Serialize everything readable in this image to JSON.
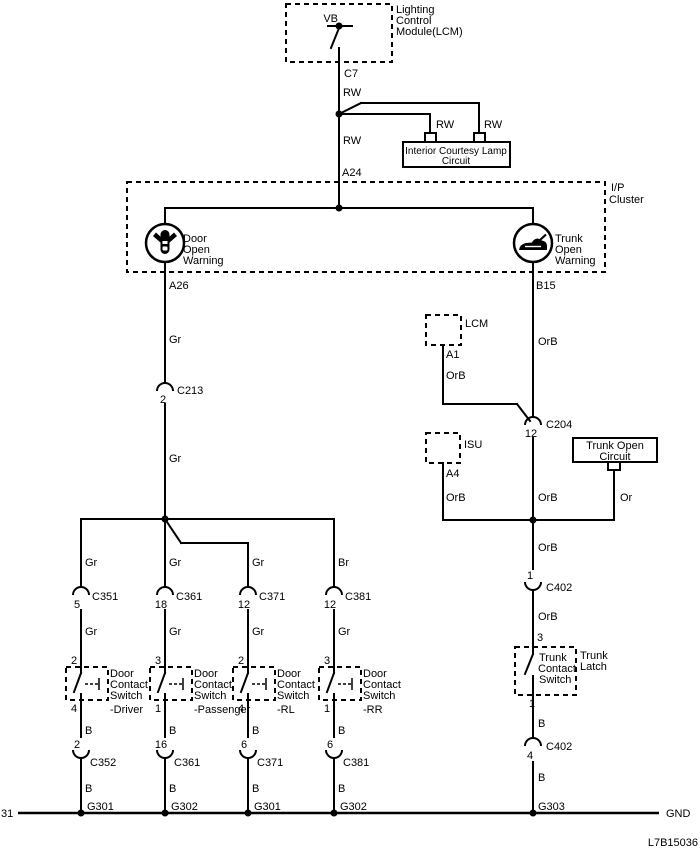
{
  "page_bg": "#ffffff",
  "ink": "#000000",
  "diagram_code": "L7B15036",
  "bus": {
    "left_label": "31",
    "right_label": "GND"
  },
  "lcm_module": {
    "title_l1": "Lighting",
    "title_l2": "Control",
    "title_l3": "Module(LCM)",
    "vb": "VB",
    "connector": "C7"
  },
  "feed": {
    "rw_top": "RW",
    "rw_mid": "RW",
    "rw_branch1": "RW",
    "rw_branch2": "RW",
    "a24": "A24"
  },
  "lamp_box": {
    "l1": "Interior Courtesy Lamp",
    "l2": "Circuit"
  },
  "cluster": {
    "tag_l1": "I/P",
    "tag_l2": "Cluster",
    "door_ind": {
      "l1": "Door",
      "l2": "Open",
      "l3": "Warning",
      "pin": "A26"
    },
    "trunk_ind": {
      "l1": "Trunk",
      "l2": "Open",
      "l3": "Warning",
      "pin": "B15"
    }
  },
  "door_branch": {
    "wire1": "Gr",
    "c213": {
      "pin": "2",
      "name": "C213"
    },
    "wire2": "Gr",
    "wires_top": [
      "Gr",
      "Gr",
      "Gr",
      "Br"
    ],
    "conns_top": [
      {
        "pin": "5",
        "name": "C351"
      },
      {
        "pin": "18",
        "name": "C361"
      },
      {
        "pin": "12",
        "name": "C371"
      },
      {
        "pin": "12",
        "name": "C381"
      }
    ],
    "wires_gr": [
      "Gr",
      "Gr",
      "Gr",
      "Gr"
    ],
    "switches": [
      {
        "pin_top": "2",
        "pin_bot": "4",
        "l1": "Door",
        "l2": "Contact",
        "l3": "Switch",
        "l4": "-Driver"
      },
      {
        "pin_top": "3",
        "pin_bot": "1",
        "l1": "Door",
        "l2": "Contact",
        "l3": "Switch",
        "l4": "-Passenger"
      },
      {
        "pin_top": "2",
        "pin_bot": "4",
        "l1": "Door",
        "l2": "Contact",
        "l3": "Switch",
        "l4": "-RL"
      },
      {
        "pin_top": "3",
        "pin_bot": "1",
        "l1": "Door",
        "l2": "Contact",
        "l3": "Switch",
        "l4": "-RR"
      }
    ],
    "wires_b1": [
      "B",
      "B",
      "B",
      "B"
    ],
    "conns_bot": [
      {
        "pin": "2",
        "name": "C352"
      },
      {
        "pin": "16",
        "name": "C361"
      },
      {
        "pin": "6",
        "name": "C371"
      },
      {
        "pin": "6",
        "name": "C381"
      }
    ],
    "wires_b2": [
      "B",
      "B",
      "B",
      "B"
    ],
    "grounds": [
      "G301",
      "G302",
      "G301",
      "G302"
    ]
  },
  "trunk_branch": {
    "orb1": "OrB",
    "lcm_stub": {
      "tag": "LCM",
      "pin": "A1",
      "wire": "OrB"
    },
    "c204": {
      "pin": "12",
      "name": "C204"
    },
    "isu_stub": {
      "tag": "ISU",
      "pin": "A4",
      "wire": "OrB"
    },
    "trunk_open_box": {
      "l1": "Trunk Open",
      "l2": "Circuit",
      "wire": "Or"
    },
    "orb2": "OrB",
    "orb3": "OrB",
    "c402_upper": {
      "pin": "1",
      "name": "C402"
    },
    "orb4": "OrB",
    "pin_in": "3",
    "latch": {
      "l1": "Trunk",
      "l2": "Contact",
      "l3": "Switch",
      "tag_l1": "Trunk",
      "tag_l2": "Latch",
      "pin_out": "1"
    },
    "b1": "B",
    "c402_lower": {
      "pin": "4",
      "name": "C402"
    },
    "b2": "B",
    "ground": "G303"
  }
}
